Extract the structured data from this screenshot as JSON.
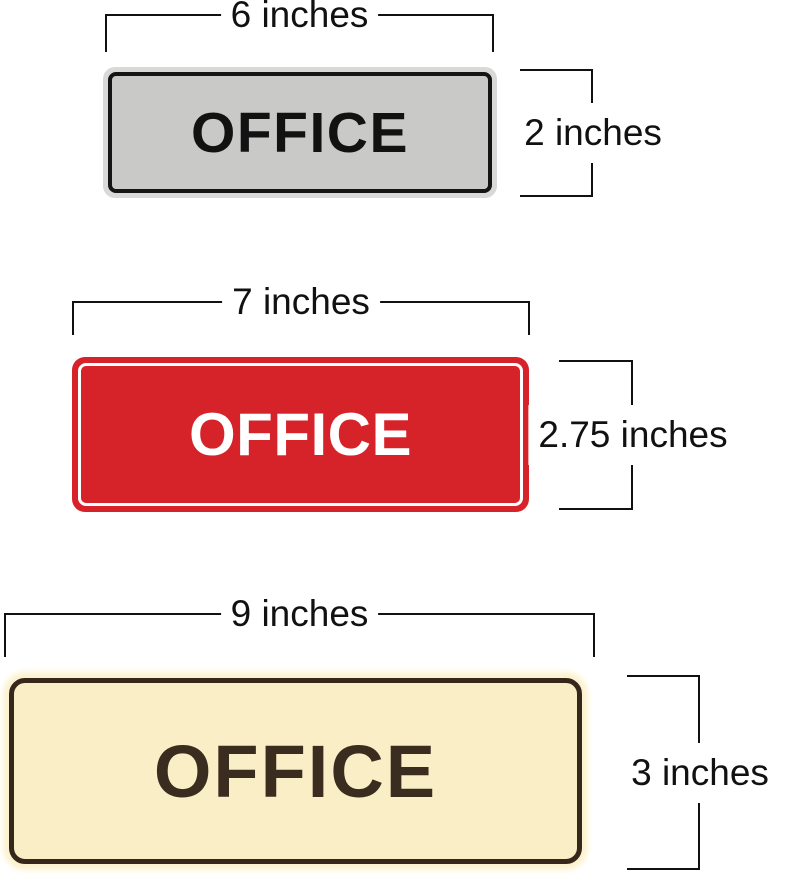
{
  "title": "OFFICE sign size diagram",
  "annotation": {
    "line_color": "#111111",
    "text_color": "#111111",
    "background": "#ffffff"
  },
  "signs": [
    {
      "name": "gray-office-sign",
      "text": "OFFICE",
      "width_label": "6 inches",
      "height_label": "2 inches",
      "colors": {
        "rim": "#d9d9d7",
        "border": "#151515",
        "fill": "#c9c9c7",
        "text": "#121212"
      }
    },
    {
      "name": "red-office-sign",
      "text": "OFFICE",
      "width_label": "7 inches",
      "height_label": "2.75 inches",
      "colors": {
        "fill": "#d62329",
        "ring": "#ffffff",
        "text": "#ffffff"
      }
    },
    {
      "name": "cream-office-sign",
      "text": "OFFICE",
      "width_label": "9 inches",
      "height_label": "3 inches",
      "colors": {
        "fill": "#faeec6",
        "border": "#35281a",
        "glow": "#fcf2cf",
        "text": "#3a2c1e"
      }
    }
  ]
}
